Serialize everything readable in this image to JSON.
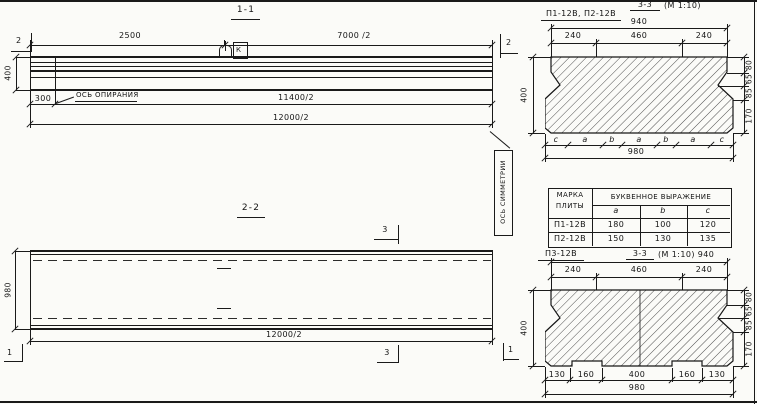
{
  "drawing": {
    "section_1_1": {
      "title": "1-1",
      "marker_left": "2",
      "marker_right": "2",
      "dim_2500": "2500",
      "dim_7000": "7000 /2",
      "dim_400": "400",
      "dim_300": "300",
      "support_axis_label": "ОСЬ ОПИРАНИЯ",
      "dim_11400": "11400/2",
      "dim_12000": "12000/2",
      "loop_tag": "К"
    },
    "section_2_2": {
      "title": "2-2",
      "marker_top": "3",
      "marker_bottom": "3",
      "marker_left": "1",
      "marker_right": "1",
      "dim_980": "980",
      "dim_12000": "12000/2",
      "symmetry_axis_label": "ОСЬ СИММЕТРИИ"
    },
    "section_3_3_top": {
      "plates_label": "П1-12В, П2-12В",
      "title": "3-3",
      "scale": "(М 1:10)",
      "dim_940": "940",
      "dim_240_left": "240",
      "dim_460": "460",
      "dim_240_right": "240",
      "dim_400": "400",
      "dim_80": "80",
      "dim_65": "65",
      "dim_85": "85",
      "dim_170": "170",
      "letters": [
        "c",
        "a",
        "b",
        "a",
        "b",
        "a",
        "c"
      ],
      "dim_980": "980"
    },
    "table": {
      "header_mark_line1": "МАРКА",
      "header_mark_line2": "ПЛИТЫ",
      "header_expr": "БУКВЕННОЕ  ВЫРАЖЕНИЕ",
      "columns": [
        "a",
        "b",
        "c"
      ],
      "rows": [
        {
          "mark": "П1-12В",
          "a": "180",
          "b": "100",
          "c": "120"
        },
        {
          "mark": "П2-12В",
          "a": "150",
          "b": "130",
          "c": "135"
        }
      ]
    },
    "section_3_3_bottom": {
      "plate_label": "П3-12В",
      "title": "3-3",
      "scale": "(М 1:10)",
      "dim_940": "940",
      "dim_240_left": "240",
      "dim_460": "460",
      "dim_240_right": "240",
      "dim_400": "400",
      "dim_80": "80",
      "dim_65": "65",
      "dim_85": "85",
      "dim_170": "170",
      "bottom_dims": [
        "130",
        "160",
        "400",
        "160",
        "130"
      ],
      "dim_980": "980"
    }
  }
}
